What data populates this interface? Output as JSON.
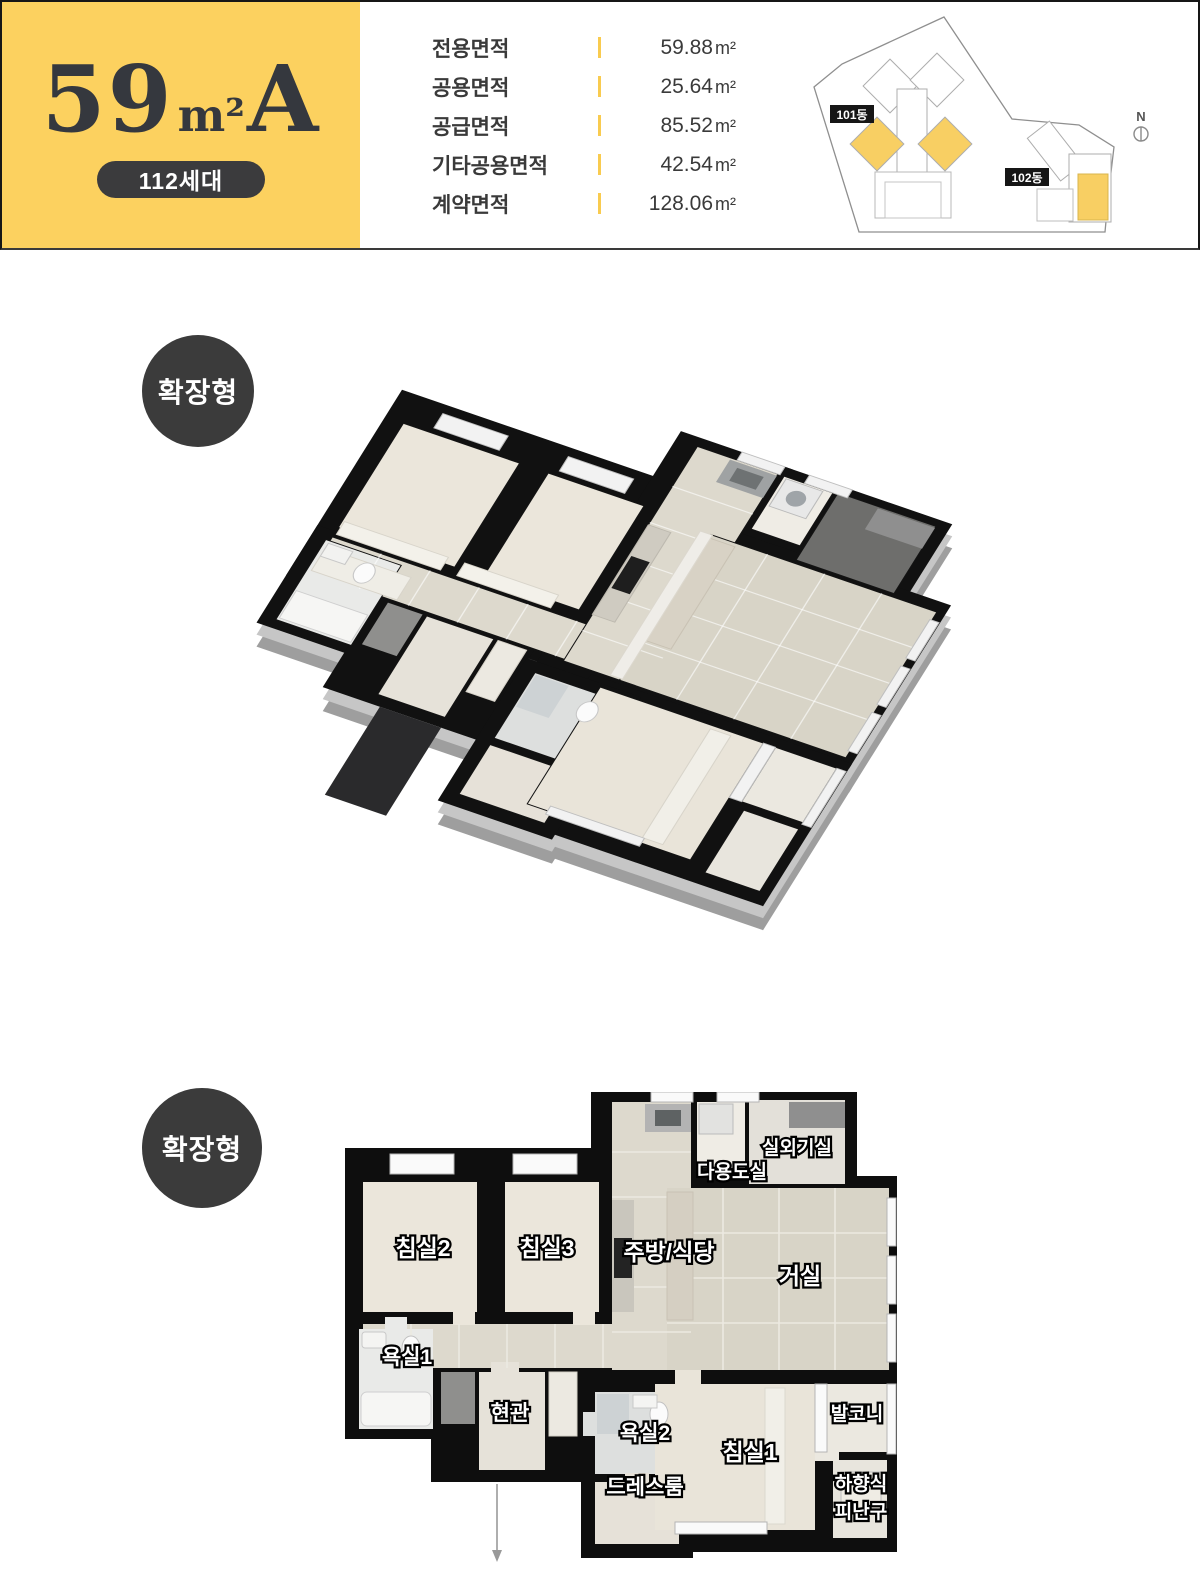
{
  "header": {
    "unit": {
      "size": "59",
      "unit": "m²",
      "type": "A",
      "households": "112세대"
    },
    "specs": [
      {
        "label": "전용면적",
        "value": "59.88",
        "unit": "m²"
      },
      {
        "label": "공용면적",
        "value": "25.64",
        "unit": "m²"
      },
      {
        "label": "공급면적",
        "value": "85.52",
        "unit": "m²"
      },
      {
        "label": "기타공용면적",
        "value": "42.54",
        "unit": "m²"
      },
      {
        "label": "계약면적",
        "value": "128.06",
        "unit": "m²"
      }
    ],
    "site_plan": {
      "building_101": "101동",
      "building_102": "102동",
      "compass_north": "N",
      "highlight_color": "#F8CF63"
    }
  },
  "sections": {
    "iso": {
      "badge": "확장형"
    },
    "flat": {
      "badge": "확장형"
    }
  },
  "rooms": {
    "bedroom2": "침실2",
    "bedroom3": "침실3",
    "kitchen_dining": "주방/식당",
    "living": "거실",
    "ac_room": "실외기실",
    "utility": "다용도실",
    "bath1": "욕실1",
    "entrance": "현관",
    "bath2": "욕실2",
    "dress_room": "드레스룸",
    "bedroom1": "침실1",
    "balcony": "발코니",
    "escape_line1": "하향식",
    "escape_line2": "피난구"
  },
  "colors": {
    "brand_yellow": "#FCD15F",
    "badge_dark": "#3B3B3B",
    "wall_black": "#111111",
    "title_text": "#35383E",
    "divider_yellow": "#F9CB4F"
  }
}
